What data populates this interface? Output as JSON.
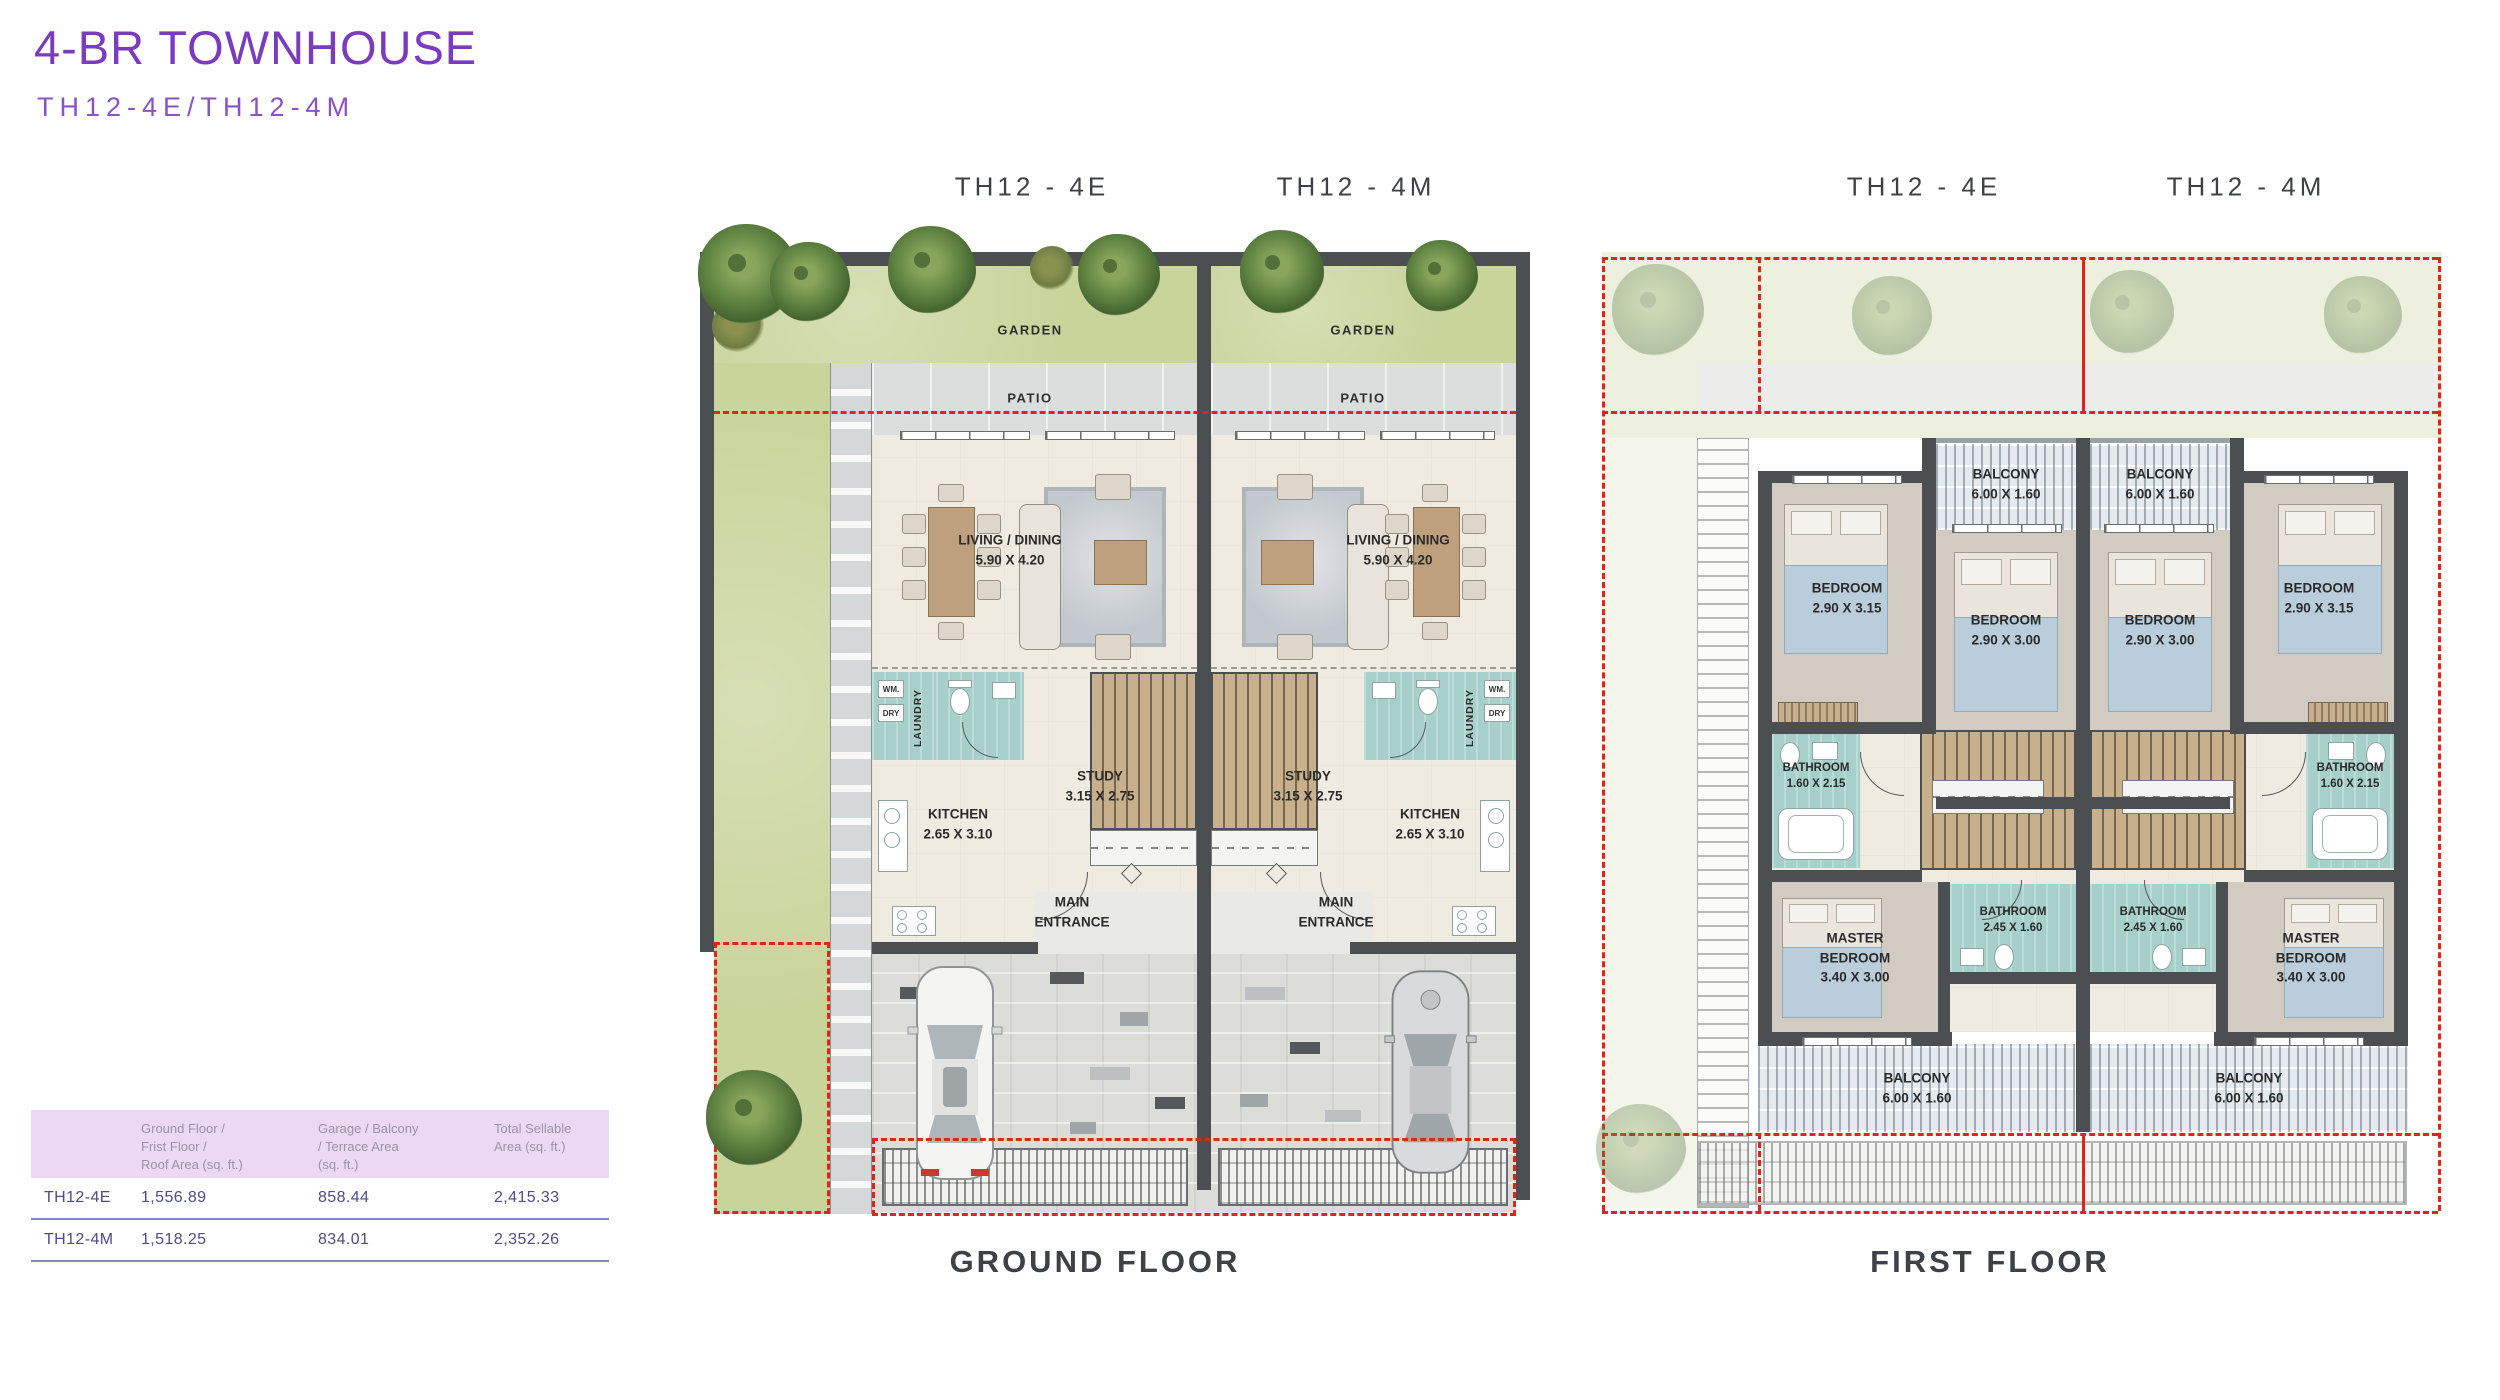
{
  "header": {
    "title": "4-BR TOWNHOUSE",
    "subtitle": "TH12-4E/TH12-4M"
  },
  "unit_labels": {
    "left": "TH12 - 4E",
    "right": "TH12 - 4M"
  },
  "captions": {
    "ground": "GROUND FLOOR",
    "first": "FIRST FLOOR"
  },
  "ground_rooms": {
    "garden": "GARDEN",
    "patio": "PATIO",
    "living": {
      "name": "LIVING / DINING",
      "dims": "5.90 X 4.20"
    },
    "laundry": "LAUNDRY",
    "wm": "WM.",
    "dry": "DRY",
    "study": {
      "name": "STUDY",
      "dims": "3.15 X 2.75"
    },
    "kitchen": {
      "name": "KITCHEN",
      "dims": "2.65 X 3.10"
    },
    "entrance": "MAIN ENTRANCE"
  },
  "first_rooms": {
    "balcony": {
      "name": "BALCONY",
      "dims": "6.00 X 1.60"
    },
    "bedroom_a": {
      "name": "BEDROOM",
      "dims": "2.90 X 3.15"
    },
    "bedroom_b": {
      "name": "BEDROOM",
      "dims": "2.90 X 3.00"
    },
    "bathroom_a": {
      "name": "BATHROOM",
      "dims": "1.60 X 2.15"
    },
    "bathroom_b": {
      "name": "BATHROOM",
      "dims": "2.45 X 1.60"
    },
    "master": {
      "name": "MASTER BEDROOM",
      "dims": "3.40 X 3.00"
    }
  },
  "area_table": {
    "col_headers": [
      "Ground Floor /\nFrist Floor /\nRoof Area (sq. ft.)",
      "Garage / Balcony\n/ Terrace Area\n(sq. ft.)",
      "Total Sellable\nArea (sq. ft.)"
    ],
    "rows": [
      [
        "TH12-4E",
        "1,556.89",
        "858.44",
        "2,415.33"
      ],
      [
        "TH12-4M",
        "1,518.25",
        "834.01",
        "2,352.26"
      ]
    ]
  },
  "colors": {
    "title": "#7b3bbe",
    "subtitle": "#8a52c6",
    "label": "#3e4245",
    "plan": "#2b2b2b",
    "wall": "#4b4f52",
    "garden": "#c9d49b",
    "patio": "#dcdedd",
    "interior": "#f0ebe1",
    "teal": "#a6d0c9",
    "wood": "#bfa07e",
    "red": "#de2517",
    "thbg": "#ebd9f3",
    "thtx": "#9c91a6",
    "ttx": "#4d4d86",
    "tline": "#8787bf"
  }
}
